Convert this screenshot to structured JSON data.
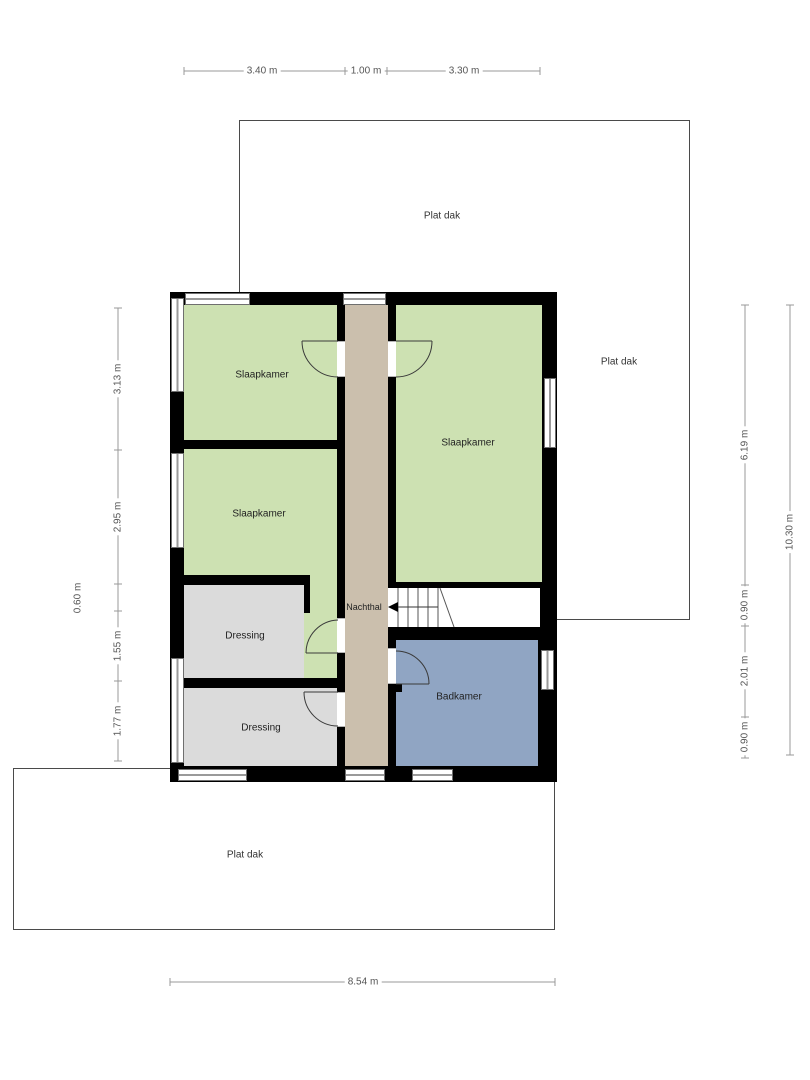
{
  "plan": {
    "roof_label": "Plat dak",
    "rooms": {
      "slaapkamer1": "Slaapkamer",
      "slaapkamer2": "Slaapkamer",
      "slaapkamer3": "Slaapkamer",
      "dressing1": "Dressing",
      "dressing2": "Dressing",
      "nachthal": "Nachthal",
      "badkamer": "Badkamer"
    },
    "dims": {
      "top1": "3.40 m",
      "top2": "1.00 m",
      "top3": "3.30 m",
      "left1": "3.13 m",
      "left2": "2.95 m",
      "left3": "0.60 m",
      "left4": "1.55 m",
      "left5": "1.77 m",
      "right1": "6.19 m",
      "right2": "0.90 m",
      "right3": "2.01 m",
      "right4": "0.90 m",
      "right_total": "10.30 m",
      "bottom": "8.54 m"
    },
    "colors": {
      "bedroom_fill": "#cde1b2",
      "hall_fill": "#cbbfad",
      "dressing_fill": "#dbdbdb",
      "bathroom_fill": "#90a5c3",
      "wall": "#000000",
      "roof_outline": "#4a4a4a",
      "dimension_line": "#999999"
    }
  }
}
